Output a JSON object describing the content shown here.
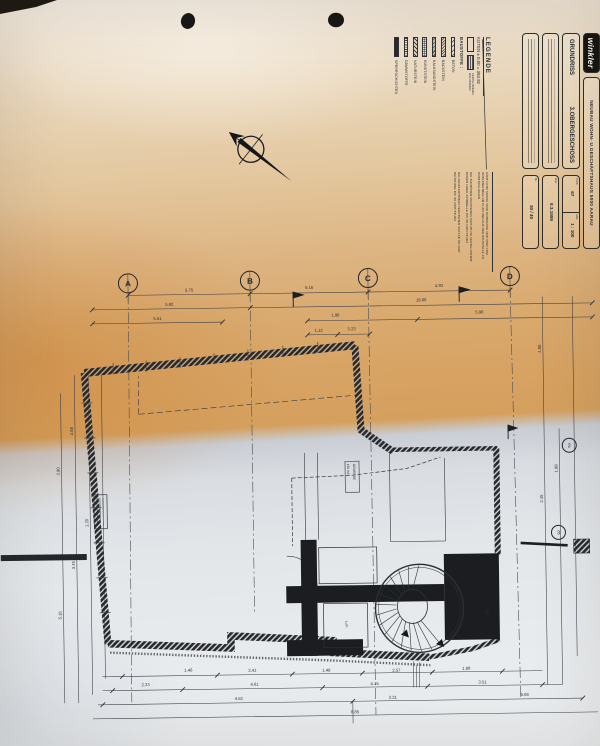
{
  "title_block": {
    "logo": "winkler",
    "project": "NEUBAU WOHN- U.GESCHÄFTSHAUS  5000 AARAU",
    "drawing_title": "GRUNDRISS",
    "drawing_subtitle": "3.OBERGESCHOSS",
    "plnr_label": "Pl.Nr.",
    "plnr": "67",
    "mst_label": "Mst.",
    "mst": "1 : 100",
    "dat_label": "Dat.",
    "dat": "8.3.1989",
    "nr_label": "Nr.",
    "nr": "30 / 40"
  },
  "legend": {
    "heading": "LEGENDE",
    "koten": "KOTEN   ± 0.00  =  383.92",
    "floor_label_1": "FERTIG BODEN",
    "floor_label_2": "ROH BODEN",
    "baustoffe_label": "BAUSTOFFE :",
    "materials": [
      "BETON",
      "BACKSTEIN",
      "KALKSANDSTEIN",
      "KUNSTSTEIN",
      "NATURSTEIN",
      "DÄMMSTOFFE",
      "SPERRSCHICHTEN"
    ],
    "notes": [
      "SÄMTLICHE MASSE SIND ROHMASSE UND SIND VOM UNTERNEHMER AM PLAN UND AUF DER BAUSTELLE ZU KONTROLLIEREN",
      "DIE TÜRHÖHEN VERSTEHEN SICH AB OK FERTIG ROHEM BODEN ODER SCHWELLE BIS UK ROH STURZ",
      "DIE FENSTERHÖHEN VERSTEHEN SICH AB OK ROH BRÜSTUNG BIS UK ROH STURZ"
    ]
  },
  "plan": {
    "grid_letters": [
      "A",
      "B",
      "C",
      "D"
    ],
    "grid_numbers": [
      "2",
      "3"
    ],
    "room_stamp": [
      "GEWERBE",
      "150 m2"
    ],
    "lift_label": "LIFT",
    "dim_labels": [
      {
        "v": "5.75",
        "x": 192,
        "y": 290,
        "r": 0
      },
      {
        "v": "5.16",
        "x": 312,
        "y": 289,
        "r": 0
      },
      {
        "v": "4.93",
        "x": 442,
        "y": 289,
        "r": 0
      },
      {
        "v": "5.92",
        "x": 172,
        "y": 304,
        "r": 0
      },
      {
        "v": "18.68",
        "x": 424,
        "y": 303,
        "r": 0
      },
      {
        "v": "5.51",
        "x": 160,
        "y": 318,
        "r": 0
      },
      {
        "v": "1.98",
        "x": 338,
        "y": 317,
        "r": 0
      },
      {
        "v": "5.98",
        "x": 482,
        "y": 316,
        "r": 0
      },
      {
        "v": "1.12",
        "x": 321,
        "y": 332,
        "r": 0
      },
      {
        "v": "3.23",
        "x": 354,
        "y": 331,
        "r": 0
      },
      {
        "v": "1.46",
        "x": 186,
        "y": 670,
        "r": 0
      },
      {
        "v": "2.41",
        "x": 250,
        "y": 671,
        "r": 0
      },
      {
        "v": "1.48",
        "x": 324,
        "y": 672,
        "r": 0
      },
      {
        "v": "2.57",
        "x": 394,
        "y": 673,
        "r": 0
      },
      {
        "v": "1.88",
        "x": 464,
        "y": 672,
        "r": 0
      },
      {
        "v": "2.33",
        "x": 143,
        "y": 684,
        "r": 0
      },
      {
        "v": "4.61",
        "x": 252,
        "y": 685,
        "r": 0
      },
      {
        "v": "4.15",
        "x": 372,
        "y": 686,
        "r": 0
      },
      {
        "v": "3.51",
        "x": 480,
        "y": 686,
        "r": 0
      },
      {
        "v": "4.52",
        "x": 236,
        "y": 699,
        "r": 0
      },
      {
        "v": "3.21",
        "x": 390,
        "y": 700,
        "r": 0
      },
      {
        "v": "6.66",
        "x": 522,
        "y": 699,
        "r": 0
      },
      {
        "v": "8.85",
        "x": 352,
        "y": 714,
        "r": 0
      },
      {
        "v": "2.90",
        "x": 60,
        "y": 468,
        "r": -90
      },
      {
        "v": "4.88",
        "x": 74,
        "y": 428,
        "r": -90
      },
      {
        "v": "1.20",
        "x": 88,
        "y": 520,
        "r": -90
      },
      {
        "v": "3.45",
        "x": 74,
        "y": 562,
        "r": -90
      },
      {
        "v": "5.16",
        "x": 60,
        "y": 612,
        "r": -90
      },
      {
        "v": "4.88",
        "x": 543,
        "y": 352,
        "r": -90
      },
      {
        "v": "2.45",
        "x": 543,
        "y": 502,
        "r": -90
      },
      {
        "v": "1.98",
        "x": 558,
        "y": 472,
        "r": -90
      },
      {
        "v": "2.90",
        "x": 487,
        "y": 616,
        "r": -90
      }
    ]
  }
}
